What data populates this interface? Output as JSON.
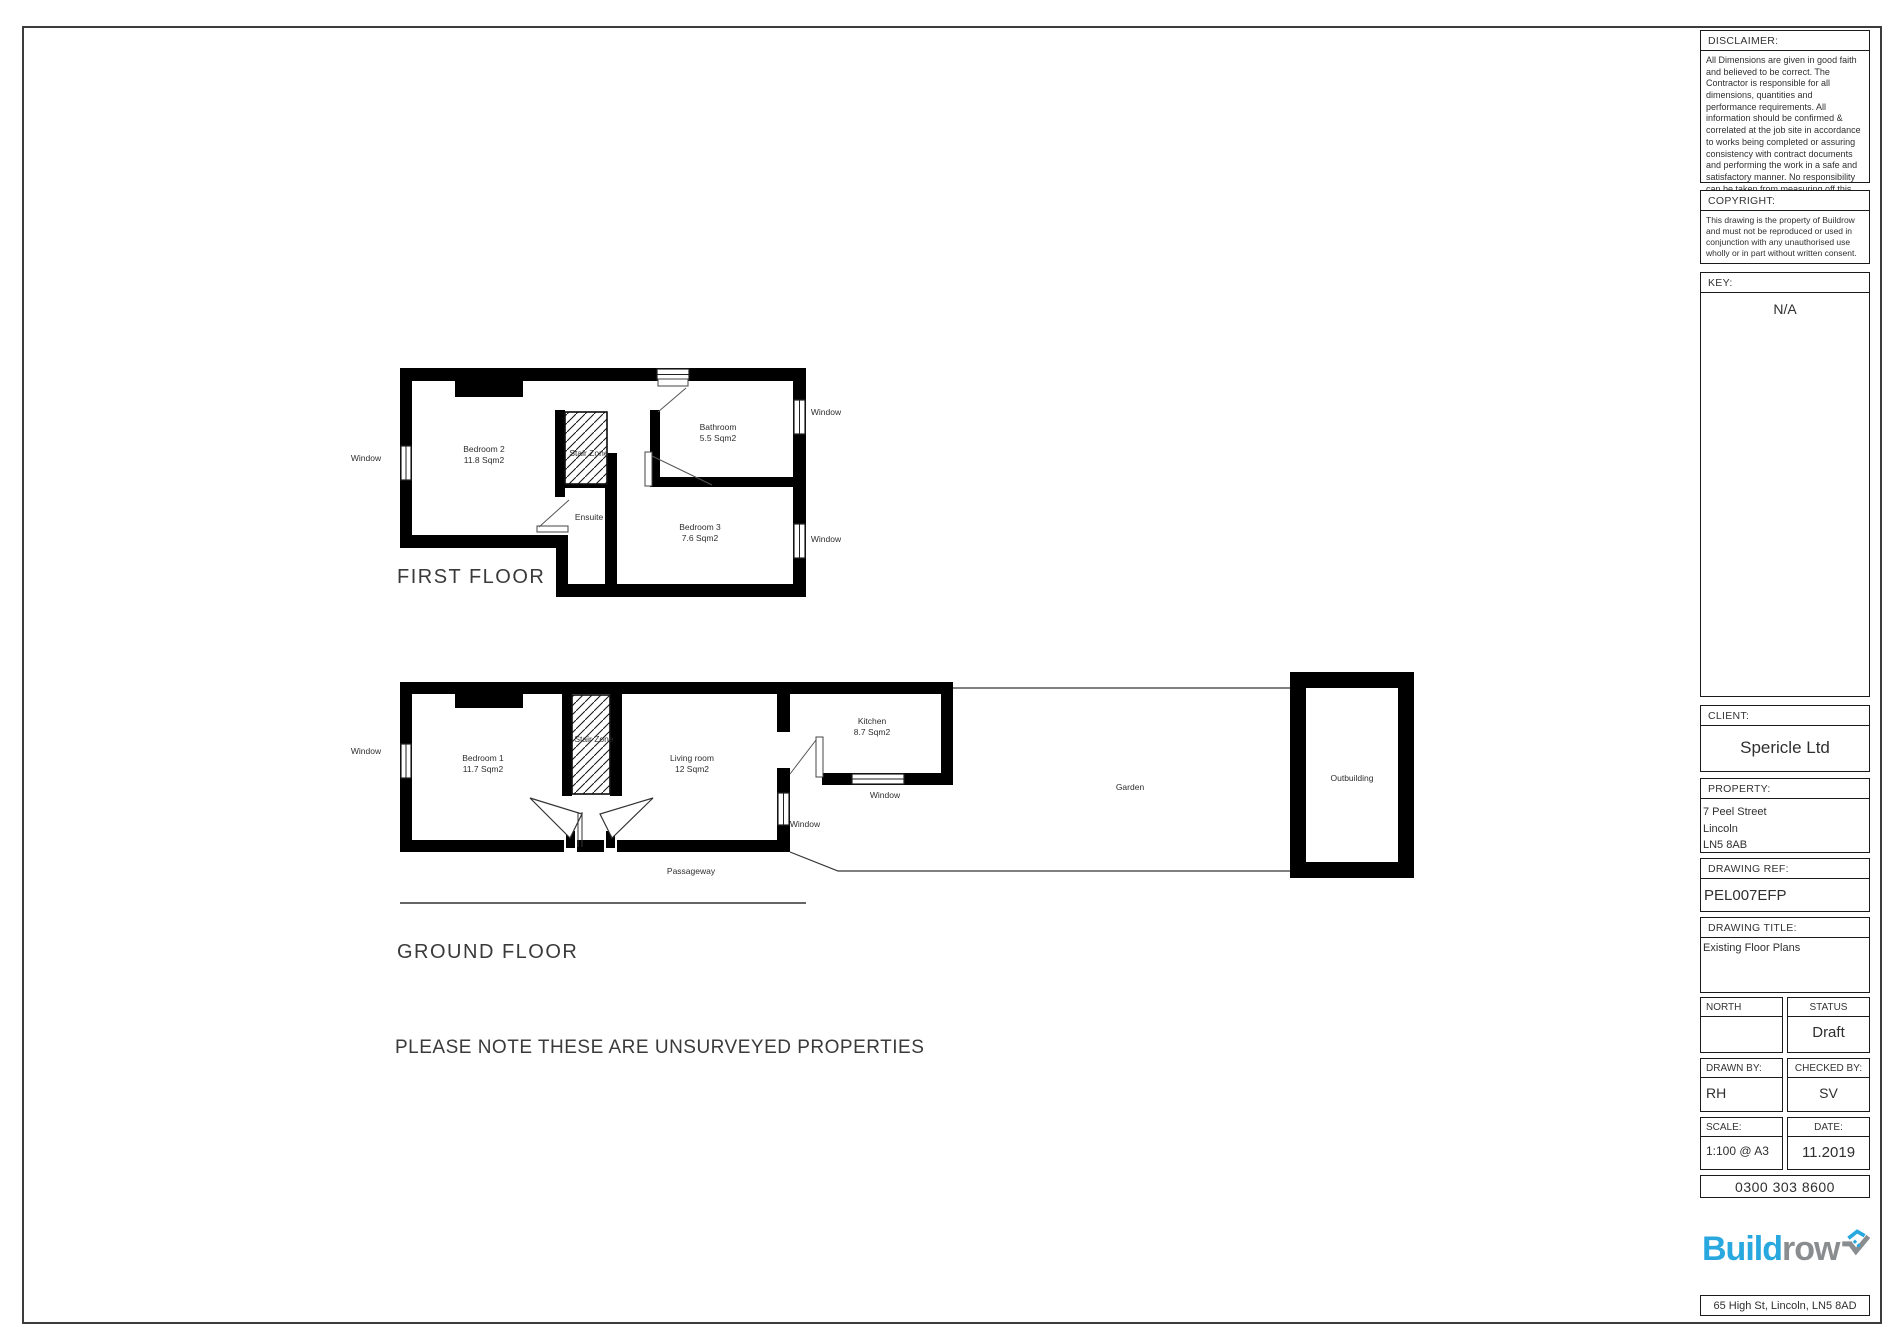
{
  "titleblock": {
    "disclaimer": {
      "label": "DISCLAIMER:",
      "text": "All Dimensions are given in good faith and believed to be correct. The Contractor is responsible for all dimensions, quantities and performance requirements. All information should be confirmed & correlated at the job site in accordance to works being completed or assuring consistency with contract documents and performing the work in a safe and satisfactory manner. No responsibility can be taken from measuring off this drawing."
    },
    "copyright": {
      "label": "COPYRIGHT:",
      "text": "This drawing is the property of Buildrow and must not be reproduced or used in conjunction with any unauthorised use wholly or in part without written consent."
    },
    "key": {
      "label": "KEY:",
      "value": "N/A"
    },
    "client": {
      "label": "CLIENT:",
      "value": "Spericle Ltd"
    },
    "property": {
      "label": "PROPERTY:",
      "line1": "7 Peel Street",
      "line2": "Lincoln",
      "line3": "LN5 8AB"
    },
    "drawing_ref": {
      "label": "DRAWING REF:",
      "value": "PEL007EFP"
    },
    "drawing_title": {
      "label": "DRAWING TITLE:",
      "value": "Existing Floor Plans"
    },
    "north": {
      "label": "NORTH",
      "value": ""
    },
    "status": {
      "label": "STATUS",
      "value": "Draft"
    },
    "drawn_by": {
      "label": "DRAWN BY:",
      "value": "RH"
    },
    "checked_by": {
      "label": "CHECKED BY:",
      "value": "SV"
    },
    "scale": {
      "label": "SCALE:",
      "value": "1:100 @ A3"
    },
    "date": {
      "label": "DATE:",
      "value": "11.2019"
    },
    "phone": "0300 303 8600",
    "logo": {
      "part1": "Build",
      "part2": "row"
    },
    "footer_address": "65 High St, Lincoln, LN5 8AD"
  },
  "drawing": {
    "window_label": "Window",
    "note": "PLEASE NOTE THESE ARE UNSURVEYED PROPERTIES",
    "first_floor": {
      "title": "FIRST FLOOR",
      "rooms": {
        "bedroom2": {
          "name": "Bedroom 2",
          "area": "11.8 Sqm2"
        },
        "bathroom": {
          "name": "Bathroom",
          "area": "5.5 Sqm2"
        },
        "bedroom3": {
          "name": "Bedroom 3",
          "area": "7.6 Sqm2"
        },
        "stair": "Stair Zone",
        "ensuite": "Ensuite"
      }
    },
    "ground_floor": {
      "title": "GROUND FLOOR",
      "rooms": {
        "bedroom1": {
          "name": "Bedroom 1",
          "area": "11.7 Sqm2"
        },
        "living": {
          "name": "Living room",
          "area": "12 Sqm2"
        },
        "kitchen": {
          "name": "Kitchen",
          "area": "8.7 Sqm2"
        },
        "stair": "Stair Zone",
        "garden": "Garden",
        "outbuilding": "Outbuilding",
        "passageway": "Passageway"
      }
    }
  },
  "colors": {
    "wall": "#000000",
    "text": "#3a3a3a",
    "border": "#1a1a1a",
    "logo_blue": "#29a8e0",
    "logo_gray": "#8a8d8f"
  }
}
